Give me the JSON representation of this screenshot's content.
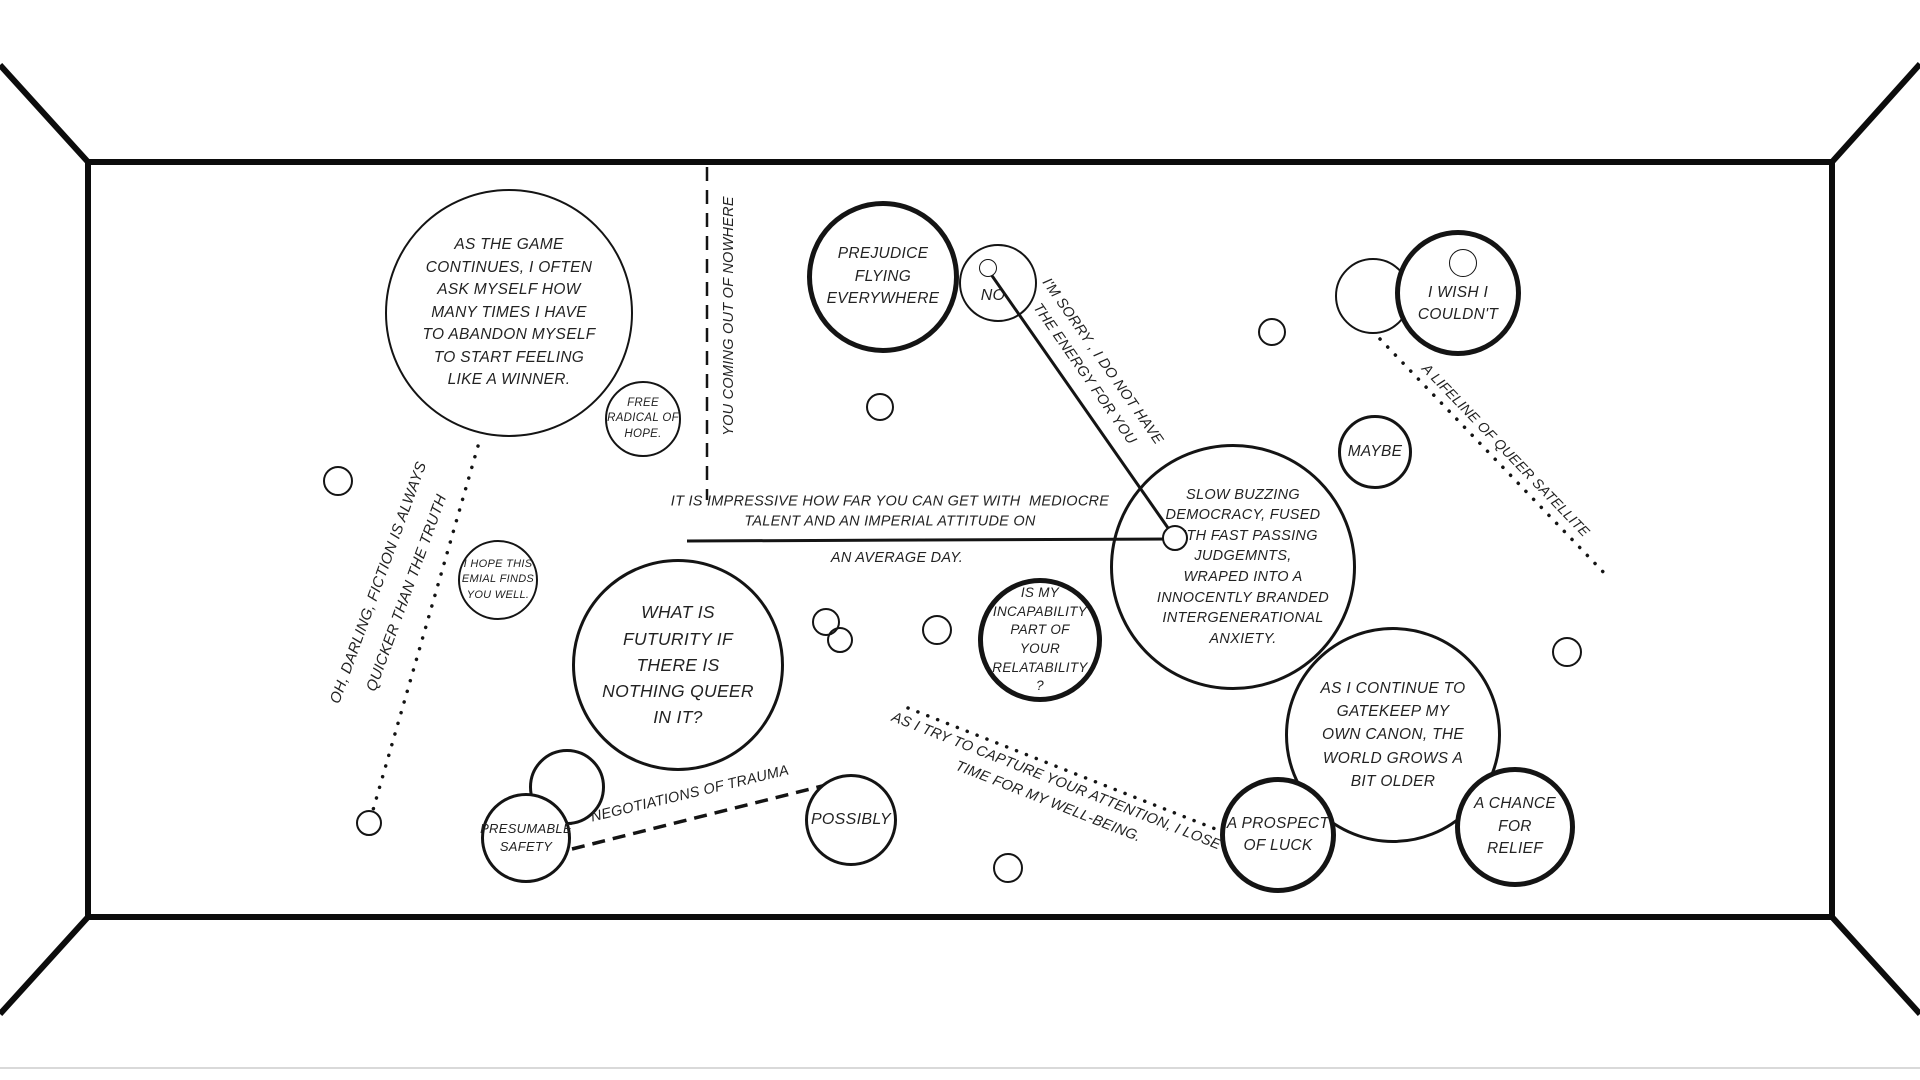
{
  "scene": {
    "background": "#ffffff",
    "ink": "#111111",
    "page_edge_color": "#d9d9d9"
  },
  "bubbles": [
    {
      "id": "as-the-game",
      "text": "AS THE GAME\nCONTINUES, I OFTEN\nASK MYSELF HOW\nMANY TIMES I HAVE\nTO ABANDON MYSELF\nTO START FEELING\nLIKE A WINNER."
    },
    {
      "id": "free-radical",
      "text": "FREE\nRADICAL OF\nHOPE."
    },
    {
      "id": "prejudice",
      "text": "PREJUDICE\nFLYING\nEVERYWHERE"
    },
    {
      "id": "no",
      "text": "NO"
    },
    {
      "id": "i-wish",
      "text": "I WISH I\nCOULDN'T"
    },
    {
      "id": "maybe",
      "text": "MAYBE"
    },
    {
      "id": "hope-email",
      "text": "I HOPE THIS\nEMIAL FINDS\nYOU WELL."
    },
    {
      "id": "futurity",
      "text": "WHAT IS\nFUTURITY IF\nTHERE IS\nNOTHING QUEER\nIN IT?"
    },
    {
      "id": "slow-buzzing",
      "text": "SLOW BUZZING\nDEMOCRACY, FUSED\nWITH FAST PASSING\nJUDGEMNTS,\nWRAPED INTO A\nINNOCENTLY BRANDED\nINTERGENERATIONAL\nANXIETY."
    },
    {
      "id": "incapability",
      "text": "IS MY\nINCAPABILITY\nPART OF\nYOUR\nRELATABILITY\n?"
    },
    {
      "id": "gatekeep",
      "text": "AS I CONTINUE TO\nGATEKEEP MY\nOWN CANON, THE\nWORLD GROWS A\nBIT OLDER"
    },
    {
      "id": "prospect",
      "text": "A PROSPECT\nOF LUCK"
    },
    {
      "id": "chance",
      "text": "A CHANCE\nFOR\nRELIEF"
    },
    {
      "id": "possibly",
      "text": "POSSIBLY"
    },
    {
      "id": "presumable",
      "text": "PRESUMABLE\nSAFETY"
    }
  ],
  "line_labels": [
    {
      "id": "you-coming",
      "text": "YOU COMING OUT OF NOWHERE"
    },
    {
      "id": "sorry",
      "text": "I'M SORRY , I DO NOT HAVE\nTHE ENERGY FOR YOU"
    },
    {
      "id": "lifeline",
      "text": "A LIFELINE OF QUEER SATELLITE"
    },
    {
      "id": "darling",
      "text": "OH, DARLING, FICTION IS ALWAYS\nQUICKER THAN THE TRUTH"
    },
    {
      "id": "impressive",
      "text": "IT IS IMPRESSIVE HOW FAR YOU CAN GET WITH  MEDIOCRE\nTALENT AND AN IMPERIAL ATTITUDE ON"
    },
    {
      "id": "average-day",
      "text": "AN AVERAGE DAY."
    },
    {
      "id": "negotiations",
      "text": "NEGOTIATIONS OF TRAUMA"
    },
    {
      "id": "as-i-try",
      "text": "AS I TRY TO CAPTURE YOUR ATTENTION, I LOSE\nTIME FOR MY WELL-BEING."
    }
  ]
}
